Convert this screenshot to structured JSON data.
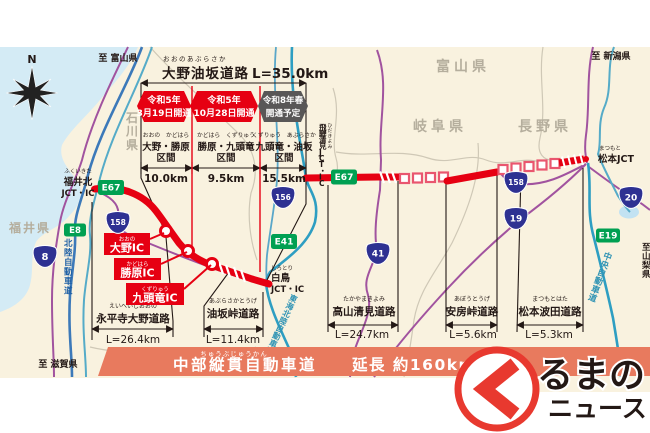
{
  "header": {
    "furigana": "おおのあぶらさか",
    "title": "大野油坂道路",
    "length": "L=35.0km",
    "banners": [
      {
        "line1": "令和5年",
        "line2": "3月19日開通"
      },
      {
        "line1": "令和5年",
        "line2": "10月28日開通"
      },
      {
        "line1": "令和8年春",
        "line2": "開通予定"
      }
    ],
    "sections": [
      {
        "furigana": "おおの　かどはら",
        "name": "大野・勝原",
        "kukan": "区間",
        "length": "10.0km"
      },
      {
        "furigana": "かどはら　くずりゅう",
        "name": "勝原・九頭竜",
        "kukan": "区間",
        "length": "9.5km"
      },
      {
        "furigana": "くずりゅう　あぶらさか",
        "name": "九頭竜・油坂",
        "kukan": "区間",
        "length": "15.5km"
      }
    ]
  },
  "compass": {
    "label": "N"
  },
  "edges": {
    "toToyama": "至 富山県",
    "toNiigata": "至 新潟県",
    "toShiga": "至 滋賀県",
    "toYamanashi": "至山梨県"
  },
  "prefectures": {
    "ishikawa": "石川県",
    "fukui": "福井県",
    "toyama": "富山県",
    "gifu": "岐阜県",
    "nagano": "長野県"
  },
  "junctions": {
    "fukuikita": {
      "furigana": "ふくいきた",
      "name": "福井北",
      "sub": "JCT・IC"
    },
    "shirotori": {
      "furigana": "しろとり",
      "name": "白鳥",
      "sub": "JCT・IC"
    },
    "hidakiyomi": {
      "furigana": "ひだきよみ",
      "name": "飛騨清見JCT・IC"
    },
    "matsumoto": {
      "furigana": "まつもと",
      "name": "松本JCT"
    }
  },
  "interchanges": [
    {
      "furigana": "おおの",
      "name": "大野IC"
    },
    {
      "furigana": "かどはら",
      "name": "勝原IC"
    },
    {
      "furigana": "くずりゅう",
      "name": "九頭竜IC"
    }
  ],
  "expressways": {
    "hokuriku": "北陸自動車道",
    "tokaiHokuriku": "東海北陸自動車道",
    "chuo": "中央自動車道"
  },
  "shields": {
    "e67w": "E67",
    "e67e": "E67",
    "e8": "E8",
    "e41": "E41",
    "e19": "E19",
    "r8": "8",
    "r158w": "158",
    "r158e": "158",
    "r156": "156",
    "r41": "41",
    "r19": "19",
    "r20": "20"
  },
  "roadSections": [
    {
      "furigana": "えいへいじおおの",
      "name": "永平寺大野道路",
      "length": "L=26.4km"
    },
    {
      "furigana": "あぶらさかとうげ",
      "name": "油坂峠道路",
      "length": "L=11.4km"
    },
    {
      "furigana": "たかやまきよみ",
      "name": "高山清見道路",
      "length": "L=24.7km"
    },
    {
      "furigana": "あぼうとうげ",
      "name": "安房峠道路",
      "length": "L=5.6km"
    },
    {
      "furigana": "まつもとはた",
      "name": "松本波田道路",
      "length": "L=5.3km"
    }
  ],
  "bottomBanner": {
    "furigana": "ちゅうぶじゅうかん",
    "title": "中部縦貫自動車道",
    "subtitle": "延長 約160km"
  },
  "logo": {
    "line1": "るまの",
    "line2": "ニュース"
  },
  "colors": {
    "expresswayRed": "#e60012",
    "plannedGray": "#595757",
    "bannerCoral": "#e87a5e",
    "routeBlue": "#2e3192",
    "expwyGreen": "#00a052",
    "land": "#f9f2df",
    "sea": "#d4ebf5"
  }
}
